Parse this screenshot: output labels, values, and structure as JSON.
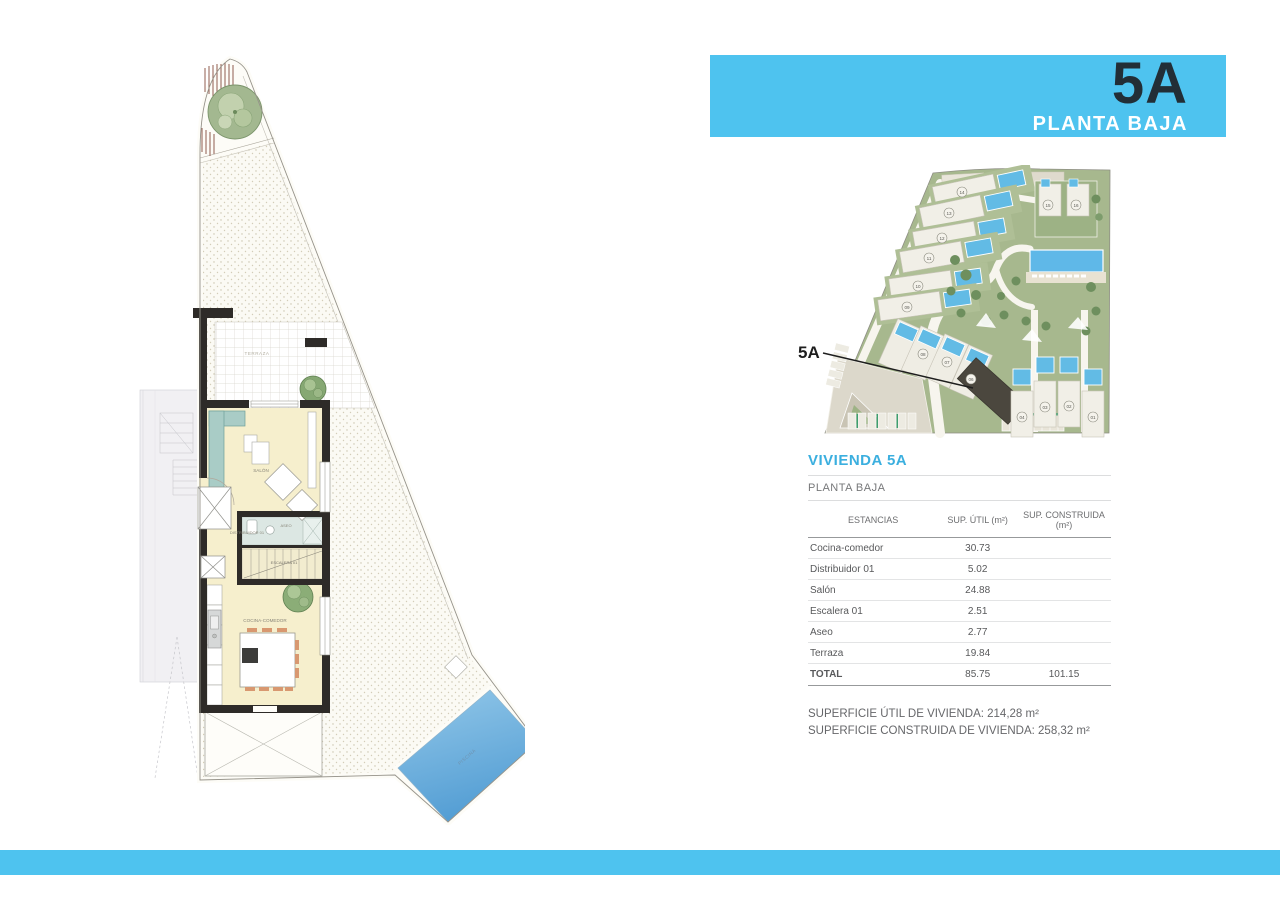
{
  "header": {
    "unit": "5A",
    "floor": "PLANTA BAJA"
  },
  "colors": {
    "accent_blue": "#4EC3EF",
    "title_blue": "#3BAFDF",
    "dark_text": "#222E36",
    "pool_blue": "#6FB9E2"
  },
  "floorplan": {
    "labels": {
      "terraza": "TERRAZA",
      "salon": "SALÓN",
      "distribuidor": "DISTRIBUIDOR 01",
      "aseo": "ASEO",
      "escalera": "ESCALERA 01",
      "cocina": "COCINA-COMEDOR",
      "piscina": "PISCINA"
    }
  },
  "siteplan": {
    "callout": "5A",
    "plots": [
      "01",
      "02",
      "03",
      "04",
      "06",
      "07",
      "08",
      "09",
      "10",
      "11",
      "12",
      "13",
      "14",
      "15",
      "16"
    ]
  },
  "panel": {
    "title": "VIVIENDA 5A",
    "subtitle": "PLANTA BAJA",
    "columns": [
      "ESTANCIAS",
      "SUP. ÚTIL (m²)",
      "SUP. CONSTRUIDA (m²)"
    ],
    "rows": [
      {
        "name": "Cocina-comedor",
        "util": "30.73"
      },
      {
        "name": "Distribuidor 01",
        "util": "5.02"
      },
      {
        "name": "Salón",
        "util": "24.88"
      },
      {
        "name": "Escalera 01",
        "util": "2.51"
      },
      {
        "name": "Aseo",
        "util": "2.77"
      },
      {
        "name": "Terraza",
        "util": "19.84"
      }
    ],
    "total": {
      "name": "TOTAL",
      "util": "85.75",
      "construida": "101.15"
    },
    "footer": {
      "line1": "SUPERFICIE ÚTIL DE VIVIENDA: 214,28 m²",
      "line2": "SUPERFICIE CONSTRUIDA DE VIVIENDA:  258,32 m²"
    }
  }
}
